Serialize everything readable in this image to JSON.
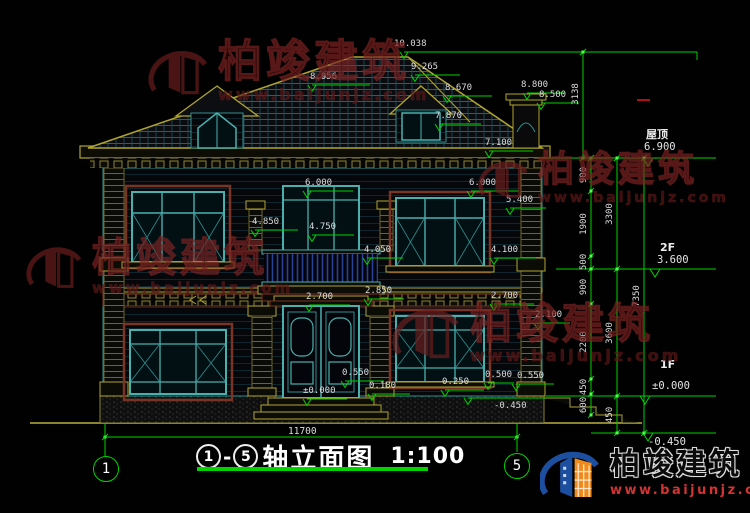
{
  "title": {
    "prefix_axis": "1",
    "dash": "-",
    "suffix_axis": "5",
    "name": "轴立面图",
    "scale": "1:100"
  },
  "axis_bubbles": {
    "left": "1",
    "right": "5"
  },
  "levels": {
    "roof": {
      "label": "屋顶",
      "value": "6.900"
    },
    "f2": {
      "label": "2F",
      "value": "3.600"
    },
    "f1": {
      "label": "1F",
      "value": "±0.000"
    },
    "base": {
      "value": "-0.450"
    }
  },
  "marks": {
    "roof_peak": "10.038",
    "roof_upper": "9.265",
    "roof_left": "8.956",
    "roof_mid": "8.670",
    "dormer_win": "7.870",
    "chimney_top": "8.800",
    "chimney_cap": "8.500",
    "eave_right": "7.100",
    "eave2_left": "6.000",
    "eave2_right": "6.000",
    "parapet_right": "5.400",
    "balcony_rail": "4.850",
    "balcony_door": "4.750",
    "balcony_floor": "4.050",
    "sill2_right": "4.100",
    "door_top": "2.700",
    "band_mid": "2.850",
    "win1_top_right": "2.700",
    "win1_right": "2.100",
    "sill1_left": "0.550",
    "step_left": "0.180",
    "ground_center": "±0.000",
    "porch_right": "0.250",
    "sill1_right": "0.500",
    "sill1_right2": "0.550",
    "porch_mid": "-0.450"
  },
  "vdims": {
    "top": "3138",
    "a1": "900",
    "a2": "1900",
    "a3": "500",
    "a4": "900",
    "a5": "2200",
    "a6": "450",
    "a7": "600",
    "b1": "3300",
    "b2": "3600",
    "b3": "450",
    "total": "7350"
  },
  "hdims": {
    "total": "11700"
  },
  "watermark": {
    "brand": "柏竣建筑",
    "url": "www.baijunjz.com"
  },
  "logo": {
    "brand": "柏竣建筑",
    "url": "www.baijunjz.com"
  },
  "colors": {
    "dim_green": "#00d300",
    "line_teal": "#2f8f8f",
    "frame_teal": "#49b0ae",
    "line_yellow": "#b0a431",
    "trim_maroon": "#7a3424",
    "watermark_red": "#6b1d1d",
    "logo_blue": "#1d4fa0",
    "logo_orange": "#f08a1d",
    "logo_url_red": "#d23333",
    "text_white": "#dcdcdc"
  }
}
